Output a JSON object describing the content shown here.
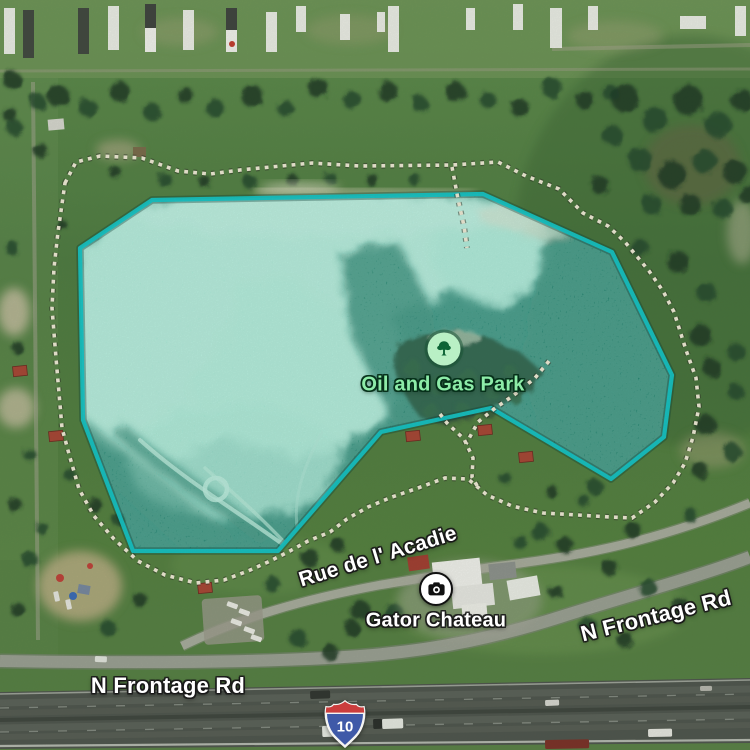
{
  "map_labels": {
    "park": {
      "name": "Oil and Gas Park"
    },
    "attraction": {
      "name": "Gator Chateau"
    },
    "street": {
      "name": "Rue de l' Acadie"
    },
    "frontage_left": {
      "name": "N Frontage Rd"
    },
    "frontage_right": {
      "name": "N Frontage Rd"
    },
    "interstate": {
      "number": "10"
    }
  },
  "icons": {
    "park_icon": "tree-icon",
    "attraction_icon": "camera-icon"
  },
  "colors": {
    "water_overlay_stroke": "#12c6c9",
    "water_overlay_fill": "rgba(45,211,196,0.17)",
    "park_label_green": "#8deca8",
    "trail_dot_cream": "#f2ecd8",
    "shield_red": "#cb3d3d",
    "shield_blue": "#3f59a8"
  }
}
